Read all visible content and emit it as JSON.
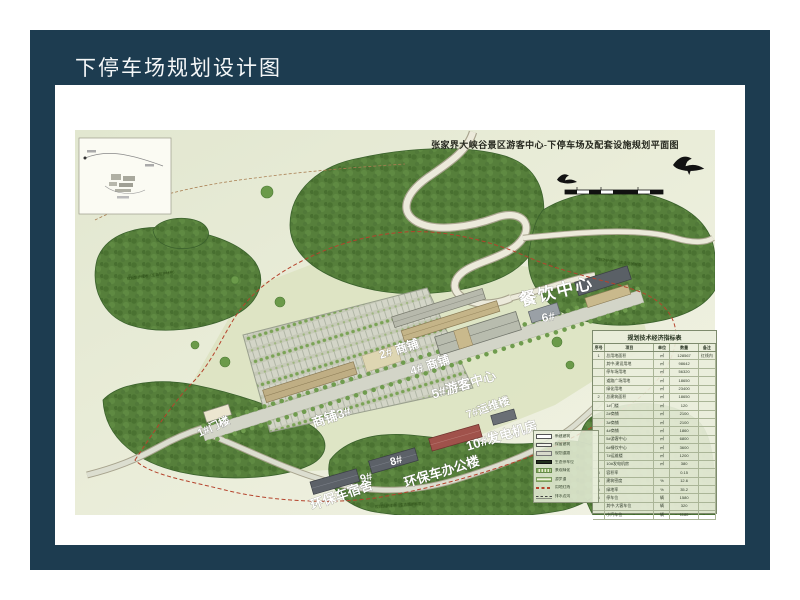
{
  "slide": {
    "title": "下停车场规划设计图"
  },
  "colors": {
    "frame": "#1d3c50",
    "map_background": "#e9ecd9",
    "forest_green": "#567f3b",
    "boundary_red": "#b5432c",
    "label_white": "#ffffff"
  },
  "map": {
    "title": "张家界大峡谷景区游客中心-下停车场及配套设施规划平面图",
    "labels": {
      "gate1": "1#门楼",
      "shop2": "2# 商铺",
      "shop3": "商铺3#",
      "shop4": "4# 商铺",
      "visitor5": "5#游客中心",
      "dining": "餐饮中心",
      "num6": "6#",
      "ops7": "7#运维楼",
      "gen10": "10#发电机房",
      "num8": "8#",
      "num9": "9#",
      "dorm": "环保车宿舍",
      "office": "环保车办公楼"
    },
    "notes": {
      "forest": "规划防护绿地（生态防护林带）"
    },
    "table": {
      "title": "规划技术经济指标表",
      "columns": [
        "序号",
        "项目",
        "单位",
        "数量",
        "备注"
      ],
      "rows": [
        {
          "no": "1",
          "item": "总用地面积",
          "unit": "㎡",
          "qty": "128567",
          "note": "红线内"
        },
        {
          "no": "",
          "item": "其中:建设用地",
          "unit": "㎡",
          "qty": "98642",
          "note": ""
        },
        {
          "no": "",
          "item": "停车场用地",
          "unit": "㎡",
          "qty": "56320",
          "note": ""
        },
        {
          "no": "",
          "item": "道路广场用地",
          "unit": "㎡",
          "qty": "18650",
          "note": ""
        },
        {
          "no": "",
          "item": "绿化用地",
          "unit": "㎡",
          "qty": "23400",
          "note": ""
        },
        {
          "no": "2",
          "item": "总建筑面积",
          "unit": "㎡",
          "qty": "18650",
          "note": ""
        },
        {
          "no": "",
          "item": "1#门楼",
          "unit": "㎡",
          "qty": "120",
          "note": ""
        },
        {
          "no": "",
          "item": "2#商铺",
          "unit": "㎡",
          "qty": "2100",
          "note": ""
        },
        {
          "no": "",
          "item": "3#商铺",
          "unit": "㎡",
          "qty": "2100",
          "note": ""
        },
        {
          "no": "",
          "item": "4#商铺",
          "unit": "㎡",
          "qty": "1860",
          "note": ""
        },
        {
          "no": "",
          "item": "5#游客中心",
          "unit": "㎡",
          "qty": "6800",
          "note": ""
        },
        {
          "no": "",
          "item": "6#餐饮中心",
          "unit": "㎡",
          "qty": "3600",
          "note": ""
        },
        {
          "no": "",
          "item": "7#运维楼",
          "unit": "㎡",
          "qty": "1200",
          "note": ""
        },
        {
          "no": "",
          "item": "10#发电机房",
          "unit": "㎡",
          "qty": "380",
          "note": ""
        },
        {
          "no": "3",
          "item": "容积率",
          "unit": "",
          "qty": "0.15",
          "note": ""
        },
        {
          "no": "4",
          "item": "建筑密度",
          "unit": "%",
          "qty": "12.6",
          "note": ""
        },
        {
          "no": "5",
          "item": "绿地率",
          "unit": "%",
          "qty": "35.2",
          "note": ""
        },
        {
          "no": "6",
          "item": "停车位",
          "unit": "辆",
          "qty": "1580",
          "note": ""
        },
        {
          "no": "",
          "item": "其中:大客车位",
          "unit": "辆",
          "qty": "320",
          "note": ""
        },
        {
          "no": "",
          "item": "小汽车位",
          "unit": "辆",
          "qty": "1180",
          "note": ""
        }
      ]
    },
    "legend": {
      "items": [
        {
          "sw": "sw-white",
          "label": "新建建筑"
        },
        {
          "sw": "sw-white2",
          "label": "保留建筑"
        },
        {
          "sw": "sw-grey",
          "label": "规划道路"
        },
        {
          "sw": "sw-dark",
          "label": "生态停车位"
        },
        {
          "sw": "sw-hatch",
          "label": "景观绿化"
        },
        {
          "sw": "sw-greenlines",
          "label": "游步道"
        },
        {
          "sw": "sw-reddash",
          "label": "用地红线"
        },
        {
          "sw": "sw-dbldash",
          "label": "排水边沟"
        }
      ]
    }
  }
}
